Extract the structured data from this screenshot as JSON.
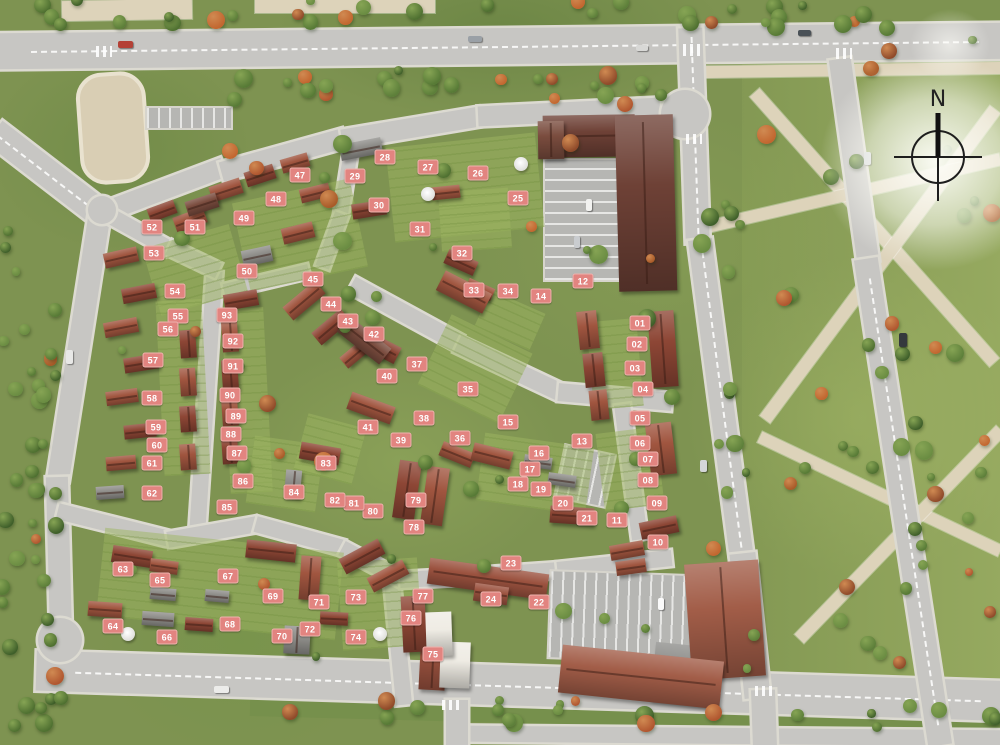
{
  "title": "Residential development masterplan - aerial site plan",
  "compass": {
    "label": "N"
  },
  "colors": {
    "badge_bg": "#e28480",
    "badge_border": "#efb3ae",
    "badge_text": "#ffffff"
  },
  "markers": [
    {
      "id": "01",
      "x": 640,
      "y": 323
    },
    {
      "id": "02",
      "x": 637,
      "y": 344
    },
    {
      "id": "03",
      "x": 635,
      "y": 368
    },
    {
      "id": "04",
      "x": 643,
      "y": 389
    },
    {
      "id": "05",
      "x": 640,
      "y": 418
    },
    {
      "id": "06",
      "x": 640,
      "y": 443
    },
    {
      "id": "07",
      "x": 648,
      "y": 459
    },
    {
      "id": "08",
      "x": 648,
      "y": 480
    },
    {
      "id": "09",
      "x": 657,
      "y": 503
    },
    {
      "id": "10",
      "x": 658,
      "y": 542
    },
    {
      "id": "11",
      "x": 617,
      "y": 520
    },
    {
      "id": "12",
      "x": 583,
      "y": 281
    },
    {
      "id": "13",
      "x": 582,
      "y": 441
    },
    {
      "id": "14",
      "x": 541,
      "y": 296
    },
    {
      "id": "15",
      "x": 508,
      "y": 422
    },
    {
      "id": "16",
      "x": 539,
      "y": 453
    },
    {
      "id": "17",
      "x": 530,
      "y": 469
    },
    {
      "id": "18",
      "x": 518,
      "y": 484
    },
    {
      "id": "19",
      "x": 541,
      "y": 489
    },
    {
      "id": "20",
      "x": 563,
      "y": 503
    },
    {
      "id": "21",
      "x": 587,
      "y": 518
    },
    {
      "id": "22",
      "x": 539,
      "y": 602
    },
    {
      "id": "23",
      "x": 511,
      "y": 563
    },
    {
      "id": "24",
      "x": 491,
      "y": 599
    },
    {
      "id": "25",
      "x": 518,
      "y": 198
    },
    {
      "id": "26",
      "x": 478,
      "y": 173
    },
    {
      "id": "27",
      "x": 428,
      "y": 167
    },
    {
      "id": "28",
      "x": 385,
      "y": 157
    },
    {
      "id": "29",
      "x": 355,
      "y": 176
    },
    {
      "id": "30",
      "x": 379,
      "y": 205
    },
    {
      "id": "31",
      "x": 420,
      "y": 229
    },
    {
      "id": "32",
      "x": 462,
      "y": 253
    },
    {
      "id": "33",
      "x": 474,
      "y": 290
    },
    {
      "id": "34",
      "x": 508,
      "y": 291
    },
    {
      "id": "35",
      "x": 468,
      "y": 389
    },
    {
      "id": "36",
      "x": 460,
      "y": 438
    },
    {
      "id": "37",
      "x": 417,
      "y": 364
    },
    {
      "id": "38",
      "x": 424,
      "y": 418
    },
    {
      "id": "39",
      "x": 401,
      "y": 440
    },
    {
      "id": "40",
      "x": 387,
      "y": 376
    },
    {
      "id": "41",
      "x": 368,
      "y": 427
    },
    {
      "id": "42",
      "x": 374,
      "y": 334
    },
    {
      "id": "43",
      "x": 348,
      "y": 321
    },
    {
      "id": "44",
      "x": 331,
      "y": 304
    },
    {
      "id": "45",
      "x": 313,
      "y": 279
    },
    {
      "id": "47",
      "x": 300,
      "y": 175
    },
    {
      "id": "48",
      "x": 276,
      "y": 199
    },
    {
      "id": "49",
      "x": 244,
      "y": 218
    },
    {
      "id": "50",
      "x": 247,
      "y": 271
    },
    {
      "id": "51",
      "x": 195,
      "y": 227
    },
    {
      "id": "52",
      "x": 152,
      "y": 227
    },
    {
      "id": "53",
      "x": 154,
      "y": 253
    },
    {
      "id": "54",
      "x": 175,
      "y": 291
    },
    {
      "id": "55",
      "x": 178,
      "y": 316
    },
    {
      "id": "56",
      "x": 168,
      "y": 329
    },
    {
      "id": "57",
      "x": 153,
      "y": 360
    },
    {
      "id": "58",
      "x": 152,
      "y": 398
    },
    {
      "id": "59",
      "x": 156,
      "y": 427
    },
    {
      "id": "60",
      "x": 157,
      "y": 445
    },
    {
      "id": "61",
      "x": 152,
      "y": 463
    },
    {
      "id": "62",
      "x": 152,
      "y": 493
    },
    {
      "id": "63",
      "x": 123,
      "y": 569
    },
    {
      "id": "64",
      "x": 113,
      "y": 626
    },
    {
      "id": "65",
      "x": 160,
      "y": 580
    },
    {
      "id": "66",
      "x": 167,
      "y": 637
    },
    {
      "id": "67",
      "x": 228,
      "y": 576
    },
    {
      "id": "68",
      "x": 230,
      "y": 624
    },
    {
      "id": "69",
      "x": 273,
      "y": 596
    },
    {
      "id": "70",
      "x": 282,
      "y": 636
    },
    {
      "id": "71",
      "x": 319,
      "y": 602
    },
    {
      "id": "72",
      "x": 310,
      "y": 629
    },
    {
      "id": "73",
      "x": 356,
      "y": 597
    },
    {
      "id": "74",
      "x": 356,
      "y": 637
    },
    {
      "id": "75",
      "x": 433,
      "y": 654
    },
    {
      "id": "76",
      "x": 411,
      "y": 618
    },
    {
      "id": "77",
      "x": 423,
      "y": 596
    },
    {
      "id": "78",
      "x": 414,
      "y": 527
    },
    {
      "id": "79",
      "x": 416,
      "y": 500
    },
    {
      "id": "80",
      "x": 373,
      "y": 511
    },
    {
      "id": "81",
      "x": 354,
      "y": 503
    },
    {
      "id": "82",
      "x": 335,
      "y": 500
    },
    {
      "id": "83",
      "x": 326,
      "y": 463
    },
    {
      "id": "84",
      "x": 294,
      "y": 492
    },
    {
      "id": "85",
      "x": 227,
      "y": 507
    },
    {
      "id": "86",
      "x": 243,
      "y": 481
    },
    {
      "id": "87",
      "x": 237,
      "y": 453
    },
    {
      "id": "88",
      "x": 231,
      "y": 434
    },
    {
      "id": "89",
      "x": 236,
      "y": 416
    },
    {
      "id": "90",
      "x": 230,
      "y": 395
    },
    {
      "id": "91",
      "x": 233,
      "y": 366
    },
    {
      "id": "92",
      "x": 233,
      "y": 341
    },
    {
      "id": "93",
      "x": 227,
      "y": 315
    }
  ]
}
